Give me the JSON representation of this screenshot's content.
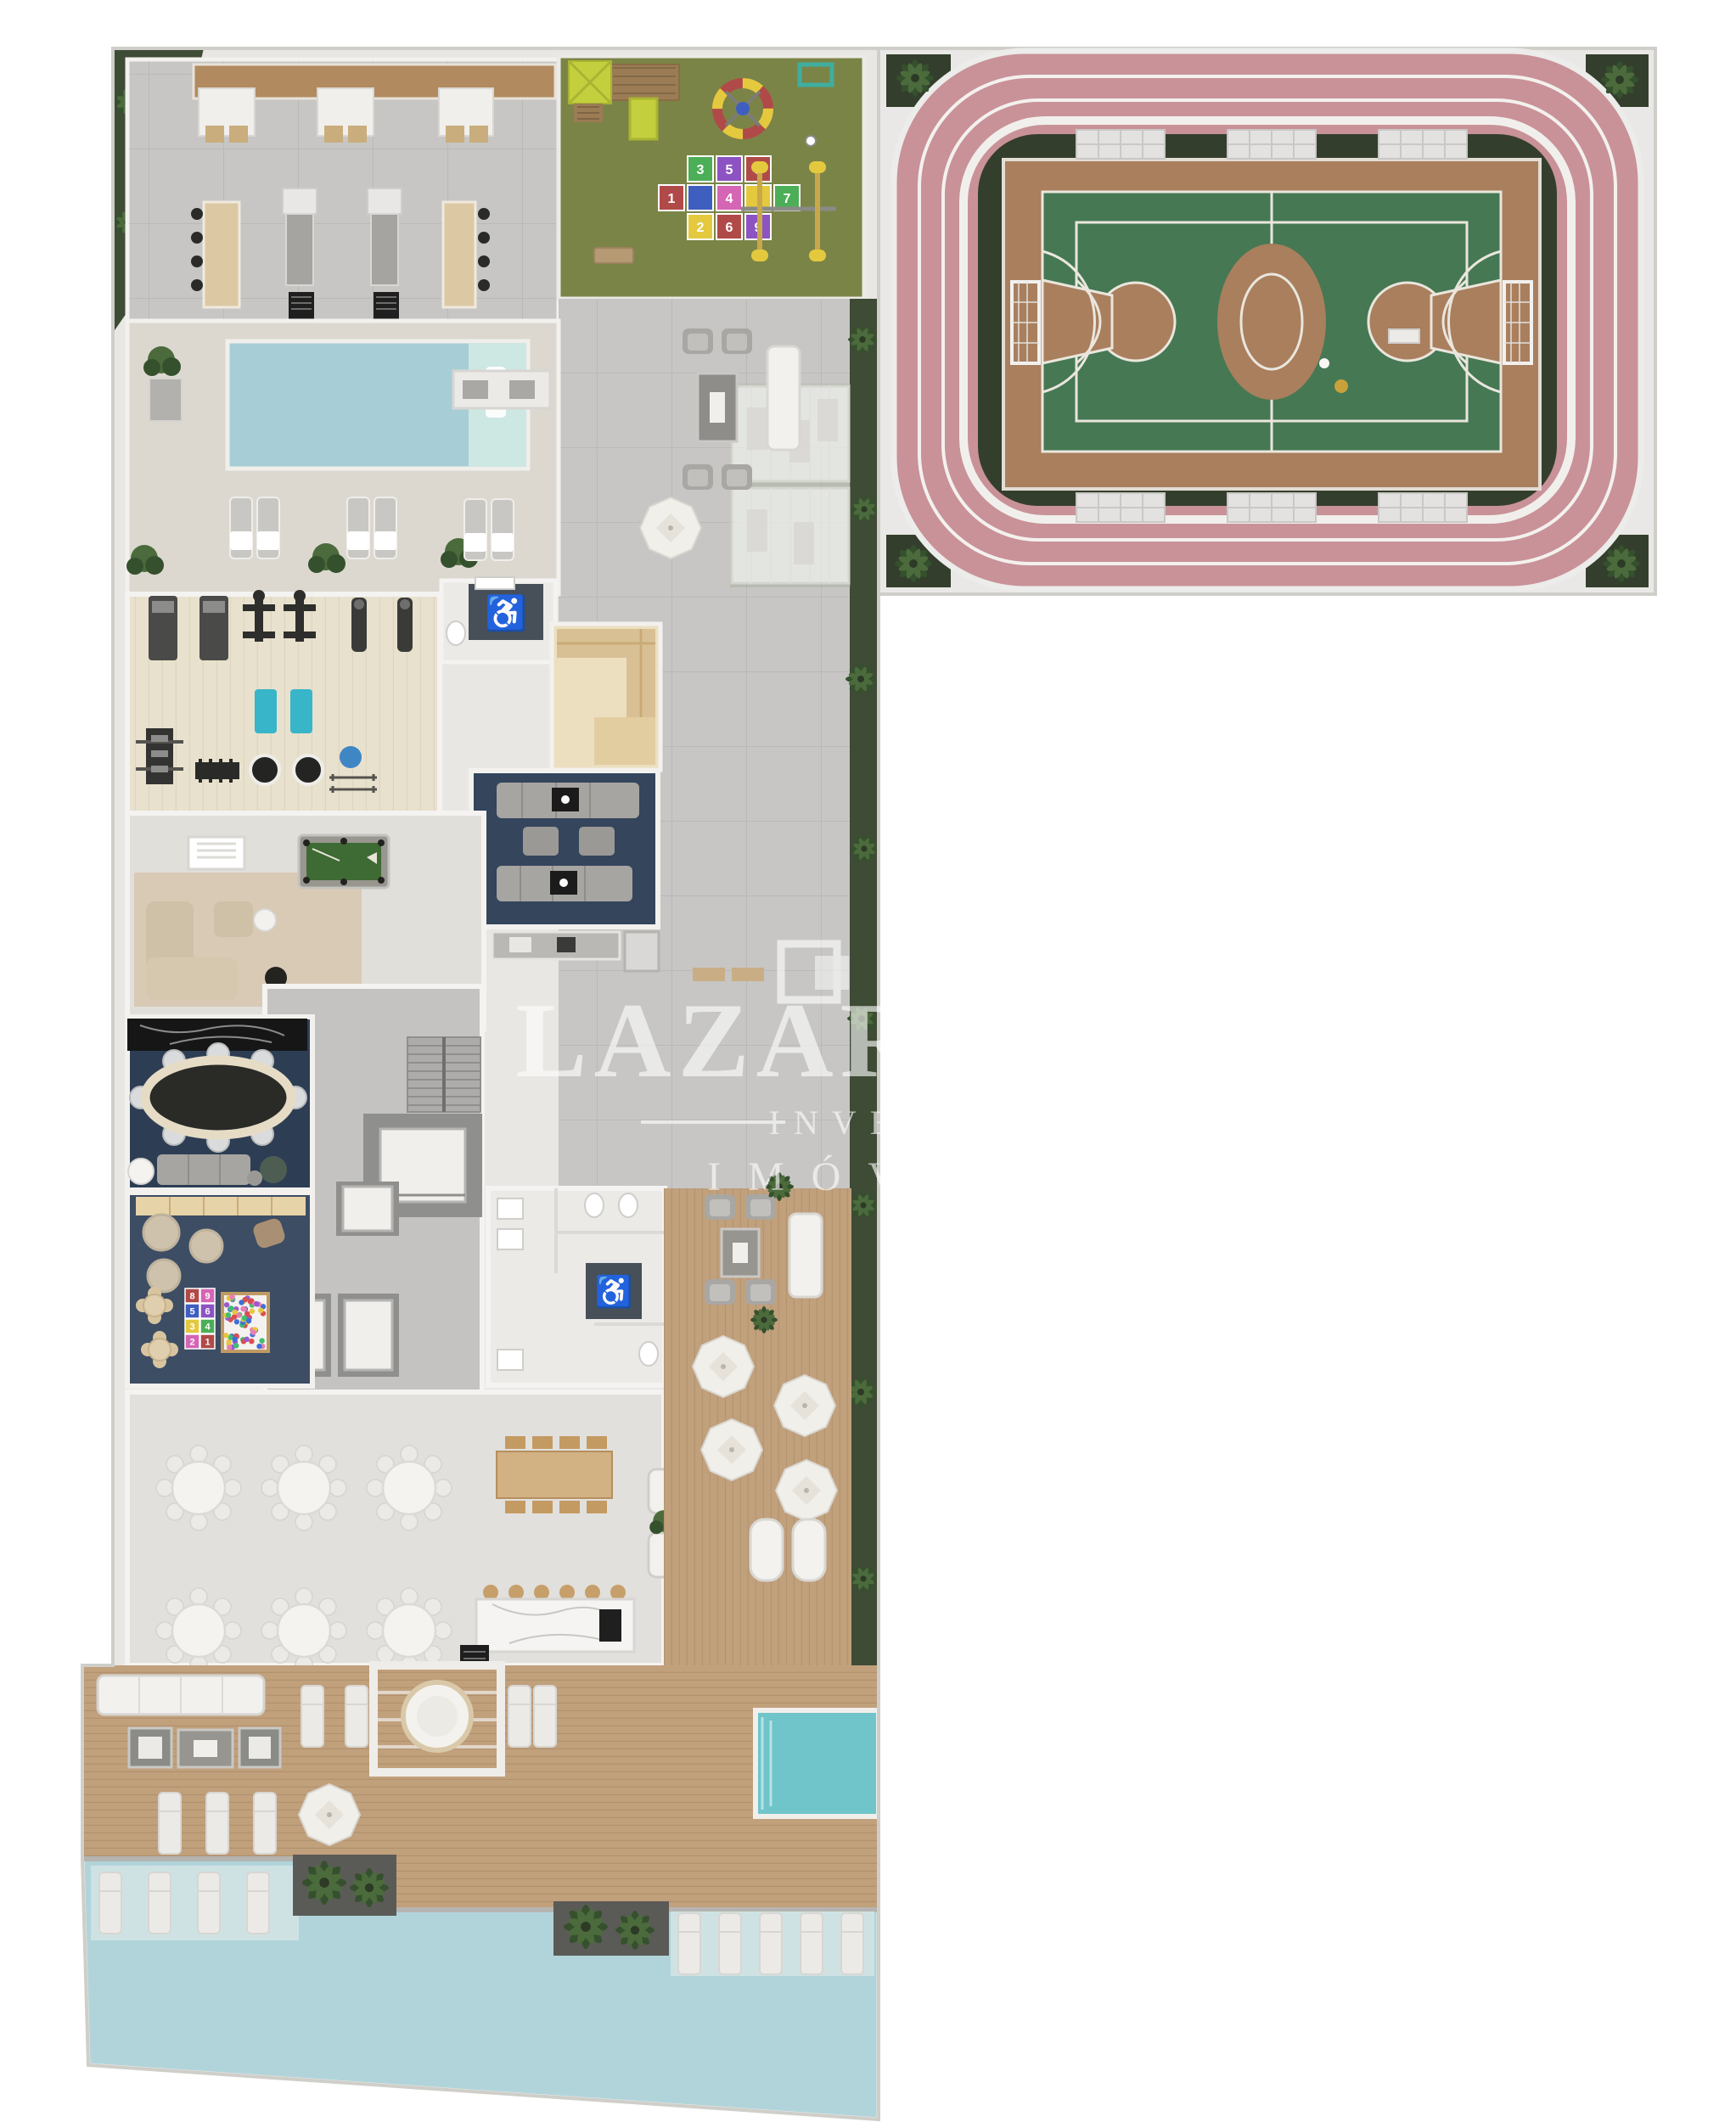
{
  "title": "Condominium amenities floor plan – aerial 3D render",
  "watermark": {
    "brand": "LAZAROTTO",
    "line2": "INVESTE",
    "line3": "IMÓVEIS"
  },
  "palette": {
    "bg": "#ffffff",
    "wallFill": "#e9e7e4",
    "wallLine": "#cfcec9",
    "paver": "#c7c6c4",
    "paverLine": "#bab9b6",
    "grass": "#3e4b35",
    "playGrass": "#7b8447",
    "trackPink": "#c99298",
    "trackLine": "#f3f1ee",
    "hedge": "#333f2c",
    "courtDeck": "#a97f5e",
    "courtGreen": "#457853",
    "courtLine": "#eae6dd",
    "poolBlue": "#a7ced6",
    "poolShallow": "#cde7e2",
    "poolBottom": "#b1d4da",
    "poolShelf": "#cfe2e3",
    "spaTeal": "#6fc5c9",
    "deck": "#c1a07c",
    "gymFloor": "#e8e1cd",
    "sauna": "#ecdfc0",
    "saunaBench": "#d9c094",
    "navy": "#34455c",
    "navyDark": "#2d3e54",
    "kidsNavy": "#3c4d64",
    "rug": "#d8c8b1",
    "hallFloor": "#e2e0dc",
    "core": "#c4c3c1",
    "shaft": "#8f8f8d",
    "furn": "#a7a5a2",
    "furnLight": "#c6c4c0",
    "whiteFurn": "#f2f1ee",
    "marble": "#f5f4f2",
    "woodFurn": "#d2b183",
    "stool": "#c69f6b",
    "matTeal": "#38b5c8",
    "ballBlue": "#3f86c5",
    "lime": "#c3cf3d",
    "toyRed": "#b04a48",
    "toyYellow": "#e4c93f",
    "toyTeal": "#3fae9f",
    "palm": "#35502d",
    "palmLight": "#4c6b3c",
    "darkFloor": "#474f58",
    "accessYellow": "#c9d83a",
    "black": "#1f1f1f"
  },
  "icons": {
    "wheelchair": "♿"
  },
  "playground": {
    "hopscotch_tiles": [
      {
        "n": "3",
        "c": "#4cae57"
      },
      {
        "n": "5",
        "c": "#8d53c2"
      },
      {
        "n": "8",
        "c": "#b04a48"
      },
      {
        "n": "1",
        "c": "#b04a48"
      },
      {
        "n": "",
        "c": "#3f5fc0"
      },
      {
        "n": "4",
        "c": "#d565b5"
      },
      {
        "n": "",
        "c": "#e4c93f"
      },
      {
        "n": "7",
        "c": "#4cae57"
      },
      {
        "n": "2",
        "c": "#e4c93f"
      },
      {
        "n": "6",
        "c": "#b04a48"
      },
      {
        "n": "9",
        "c": "#8d53c2"
      }
    ]
  },
  "kids_room": {
    "mat_tiles": [
      {
        "n": "8",
        "c": "#b04a48"
      },
      {
        "n": "9",
        "c": "#d565b5"
      },
      {
        "n": "5",
        "c": "#3f5fc0"
      },
      {
        "n": "6",
        "c": "#8d53c2"
      },
      {
        "n": "3",
        "c": "#e4c93f"
      },
      {
        "n": "4",
        "c": "#4cae57"
      },
      {
        "n": "2",
        "c": "#d565b5"
      },
      {
        "n": "1",
        "c": "#b04a48"
      }
    ],
    "ballpit_colors": [
      "#d94f4f",
      "#3f6fd9",
      "#3fbf6f",
      "#e8c53f",
      "#9b59d0",
      "#e87fb0"
    ]
  },
  "areas": [
    {
      "name": "barbecue-lounge"
    },
    {
      "name": "playground"
    },
    {
      "name": "running-track"
    },
    {
      "name": "sports-court"
    },
    {
      "name": "swimming-pool"
    },
    {
      "name": "gym"
    },
    {
      "name": "sauna"
    },
    {
      "name": "tv-lounge"
    },
    {
      "name": "games-room"
    },
    {
      "name": "gourmet-dining"
    },
    {
      "name": "kids-playroom"
    },
    {
      "name": "elevator-core"
    },
    {
      "name": "restrooms"
    },
    {
      "name": "party-hall"
    },
    {
      "name": "outdoor-deck"
    },
    {
      "name": "spa-pool"
    },
    {
      "name": "main-pool"
    }
  ]
}
